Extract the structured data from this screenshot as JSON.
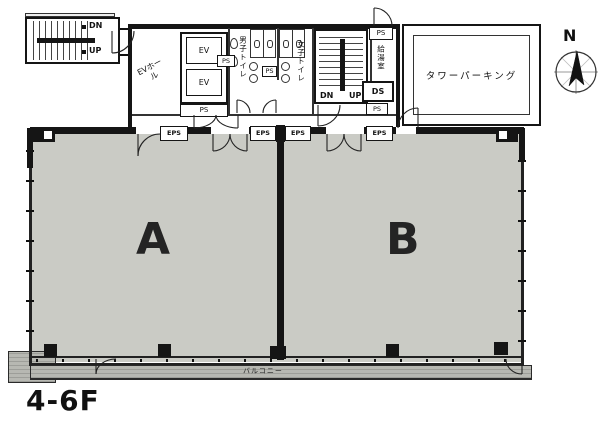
{
  "floor_label": "4-6F",
  "compass": {
    "north_label": "N"
  },
  "rooms": {
    "a": "A",
    "b": "B"
  },
  "balcony_label": "バルコニー",
  "parking_label": "タワーパーキング",
  "labels": {
    "ev": "EV",
    "ev_hall": "EVホール",
    "ps": "PS",
    "eps": "EPS",
    "ds": "DS",
    "dn": "DN",
    "up": "UP",
    "mens_toilet": "男子トイレ",
    "womens_toilet": "女子トイレ",
    "kitchenette": "給湯室"
  }
}
